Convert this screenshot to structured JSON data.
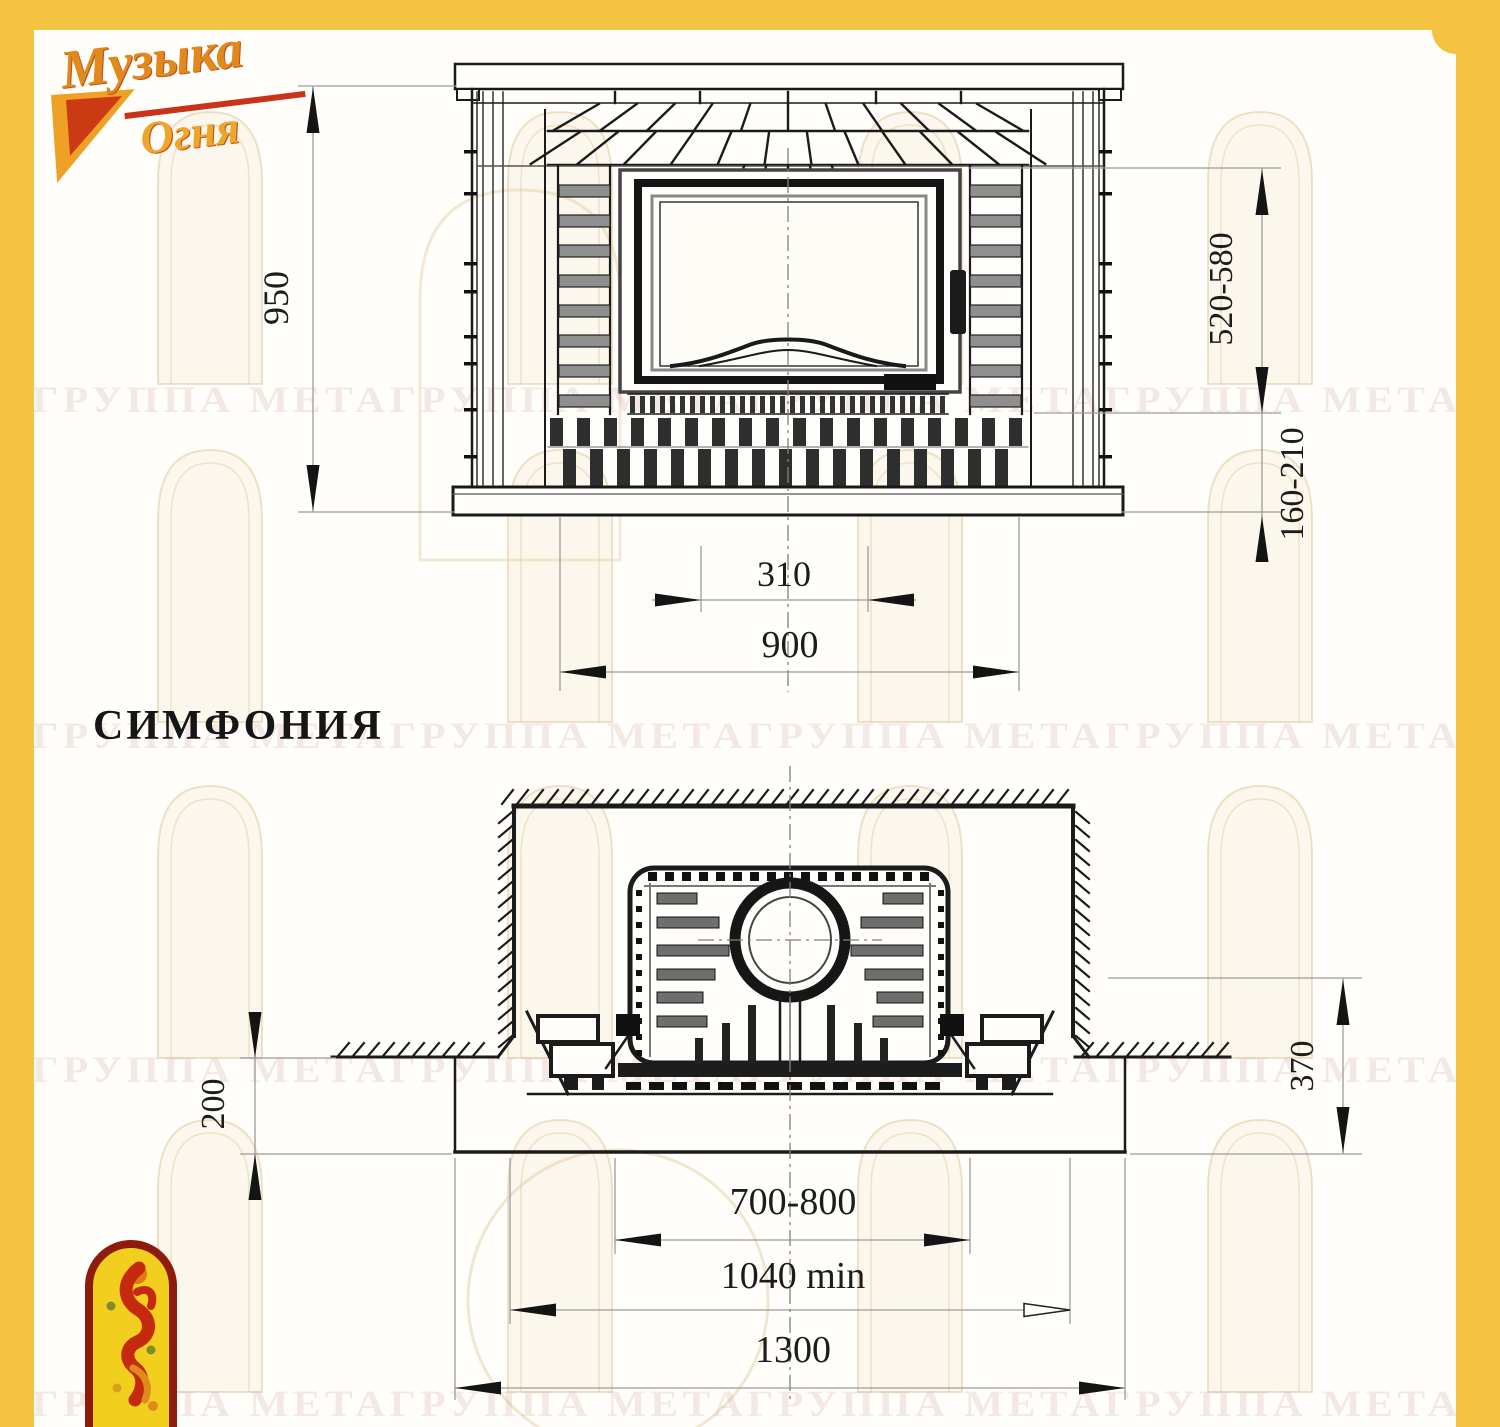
{
  "brand": {
    "line1": "Музыка",
    "line2": "Огня"
  },
  "title": "СИМФОНИЯ",
  "watermark": {
    "row_text": "ГРУППА МЕТАГРУППА МЕТАГРУППА МЕТАГРУППА МЕТА"
  },
  "front_view": {
    "dims": {
      "height": "950",
      "opening_top": "520-580",
      "opening_bottom": "160-210",
      "inner_width": "310",
      "body_width": "900"
    }
  },
  "plan_view": {
    "dims": {
      "front_depth": "200",
      "side_depth": "370",
      "insert_width": "700-800",
      "niche_width": "1040 min",
      "base_width": "1300"
    }
  },
  "colors": {
    "frame_yellow": "#F5C342",
    "accent_red": "#C93418",
    "accent_orange": "#E08A1E",
    "line_dark": "#1a1a1a"
  }
}
